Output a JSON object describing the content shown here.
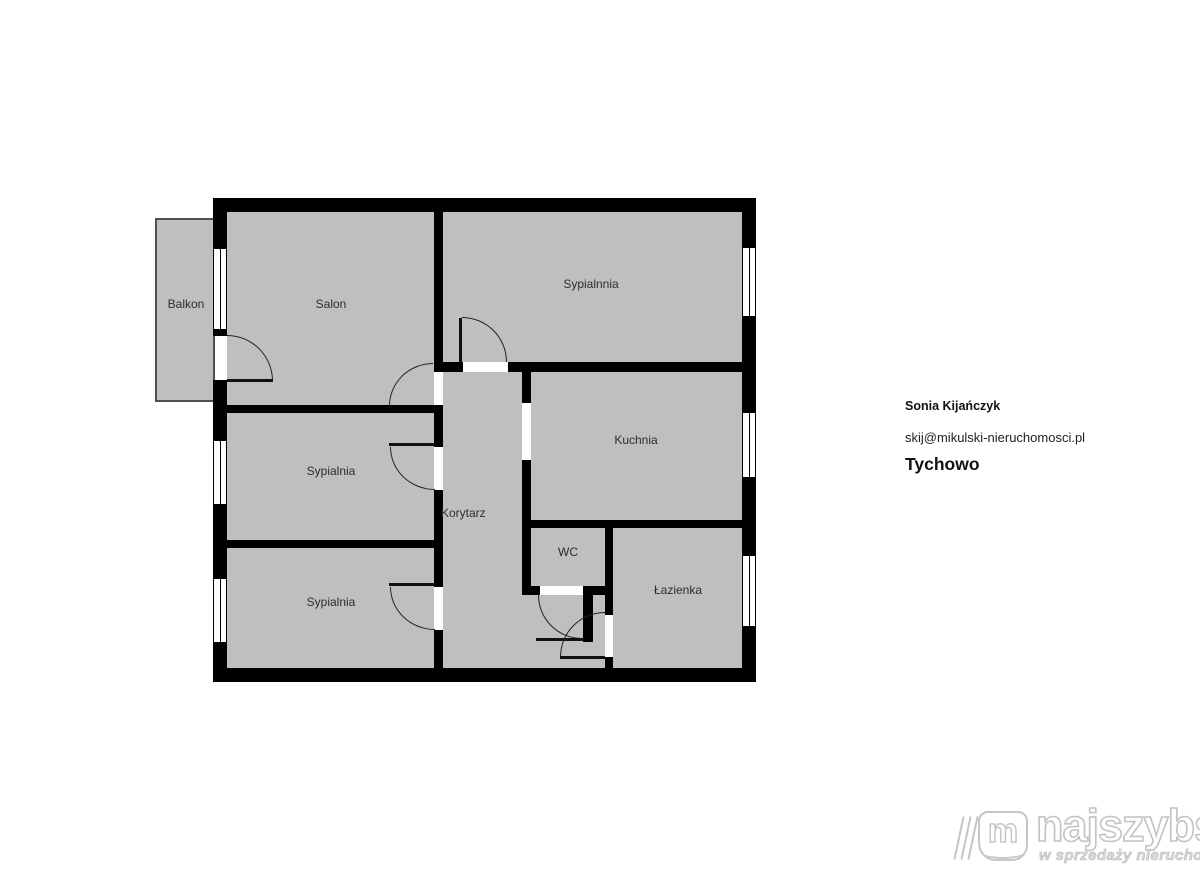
{
  "plan": {
    "rooms": [
      {
        "id": "balkon",
        "label": "Balkon"
      },
      {
        "id": "salon",
        "label": "Salon"
      },
      {
        "id": "sypialnnia",
        "label": "Sypialnnia"
      },
      {
        "id": "kuchnia",
        "label": "Kuchnia"
      },
      {
        "id": "korytarz",
        "label": "Korytarz"
      },
      {
        "id": "wc",
        "label": "WC"
      },
      {
        "id": "lazienka",
        "label": "Łazienka"
      },
      {
        "id": "sypialnia-1",
        "label": "Sypialnia"
      },
      {
        "id": "sypialnia-2",
        "label": "Sypialnia"
      }
    ],
    "colors": {
      "room_fill": "#bfbfbf",
      "wall": "#000000",
      "background": "#ffffff",
      "balcony_border": "#4f4f4f"
    }
  },
  "agent": {
    "name": "Sonia Kijańczyk",
    "email": "skij@mikulski-nieruchomosci.pl",
    "city": "Tychowo"
  },
  "logo": {
    "monogram": "m",
    "brand": "najszybsi",
    "tagline": "w sprzedaży nieruchomości",
    "color": "#c6c6c6"
  }
}
